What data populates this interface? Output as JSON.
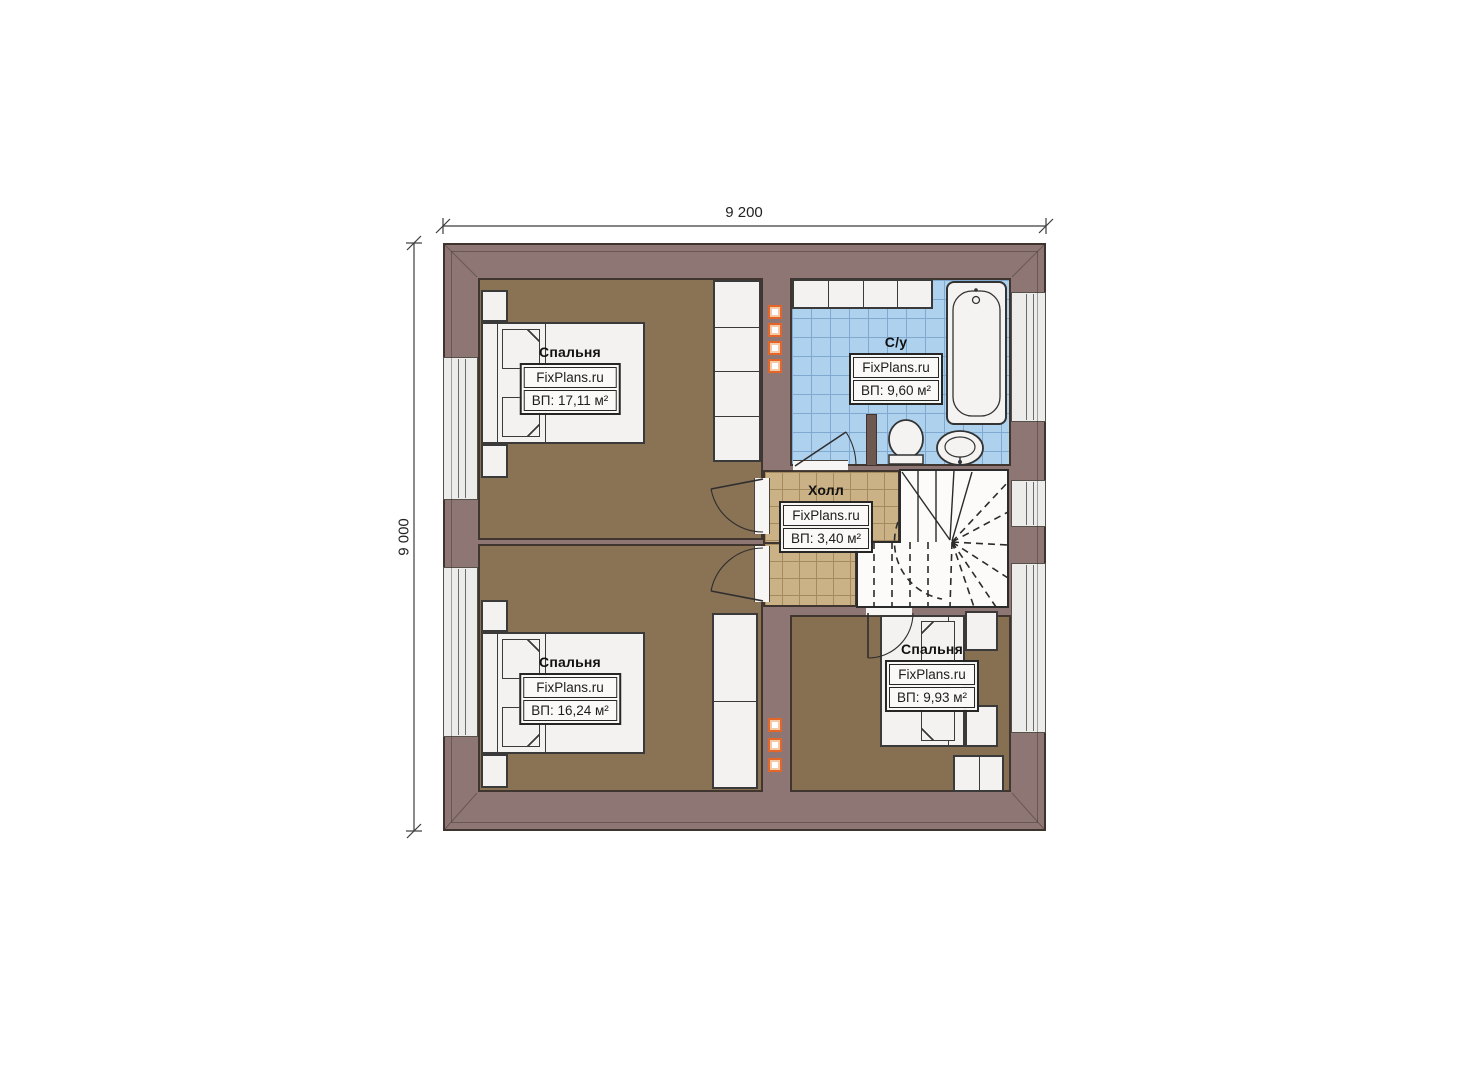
{
  "plan": {
    "dimensions": {
      "top_label": "9 200",
      "left_label": "9 000"
    },
    "rooms": [
      {
        "id": "bedroom-top-left",
        "name": "Спальня",
        "watermark": "FixPlans.ru",
        "area": "ВП: 17,11 м²"
      },
      {
        "id": "bathroom",
        "name": "С/у",
        "watermark": "FixPlans.ru",
        "area": "ВП: 9,60 м²"
      },
      {
        "id": "hall",
        "name": "Холл",
        "watermark": "FixPlans.ru",
        "area": "ВП: 3,40 м²"
      },
      {
        "id": "bedroom-bottom-left",
        "name": "Спальня",
        "watermark": "FixPlans.ru",
        "area": "ВП: 16,24 м²"
      },
      {
        "id": "bedroom-bottom-right",
        "name": "Спальня",
        "watermark": "FixPlans.ru",
        "area": "ВП: 9,93 м²"
      }
    ],
    "colors": {
      "wall": "#8e7675",
      "wood_floor": "#8a7254",
      "hall_tile": "#cbb286",
      "bath_tile": "#aed2ee",
      "vent_accent": "#e2662a"
    }
  }
}
